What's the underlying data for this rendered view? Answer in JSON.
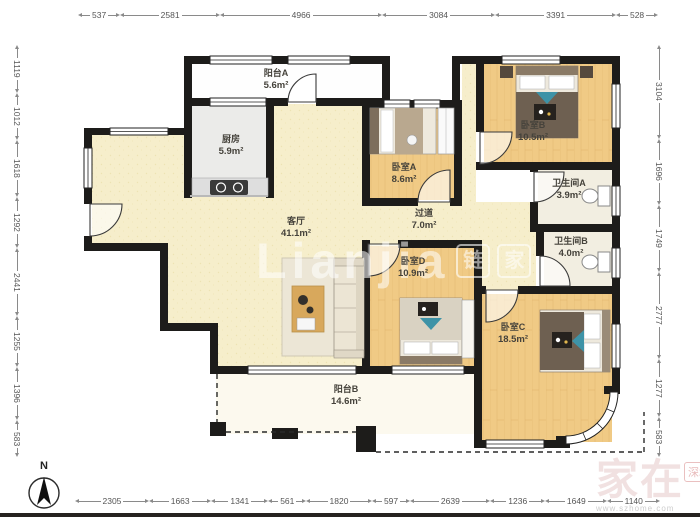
{
  "compass": {
    "label": "N"
  },
  "dims": {
    "top": [
      "537",
      "2581",
      "4966",
      "3084",
      "3391",
      "528"
    ],
    "bottom": [
      "2305",
      "1663",
      "1341",
      "561",
      "1820",
      "597",
      "2639",
      "1236",
      "1649",
      "1140"
    ],
    "left": [
      "1119",
      "1012",
      "1618",
      "1292",
      "2441",
      "1255",
      "1396",
      "583"
    ],
    "right": [
      "3104",
      "1696",
      "1749",
      "2777",
      "1277",
      "583"
    ]
  },
  "rooms": {
    "balcony_a": {
      "name": "阳台A",
      "area": "5.6m²"
    },
    "kitchen": {
      "name": "厨房",
      "area": "5.9m²"
    },
    "living": {
      "name": "客厅",
      "area": "41.1m²"
    },
    "corridor": {
      "name": "过道",
      "area": "7.0m²"
    },
    "bedroom_a": {
      "name": "卧室A",
      "area": "8.6m²"
    },
    "bedroom_b": {
      "name": "卧室B",
      "area": "10.5m²"
    },
    "bathroom_a": {
      "name": "卫生间A",
      "area": "3.9m²"
    },
    "bathroom_b": {
      "name": "卫生间B",
      "area": "4.0m²"
    },
    "bedroom_d": {
      "name": "卧室D",
      "area": "10.9m²"
    },
    "bedroom_c": {
      "name": "卧室C",
      "area": "18.5m²"
    },
    "balcony_b": {
      "name": "阳台B",
      "area": "14.6m²"
    }
  },
  "watermarks": {
    "center_text": "Lianjia",
    "center_logo_1": "链",
    "center_logo_2": "家",
    "corner_main": "家在",
    "corner_badge": "深圳",
    "corner_sub": "www.szhome.com"
  },
  "colors": {
    "wall": "#1d1c1a",
    "wood_floor": "#f0ca85",
    "cream_floor": "#f6eecb",
    "kitchen_floor": "#ebebe9",
    "bath_floor": "#f2eee1",
    "balcony_b_floor": "#fcf9ee",
    "dimension_text": "#555555"
  }
}
